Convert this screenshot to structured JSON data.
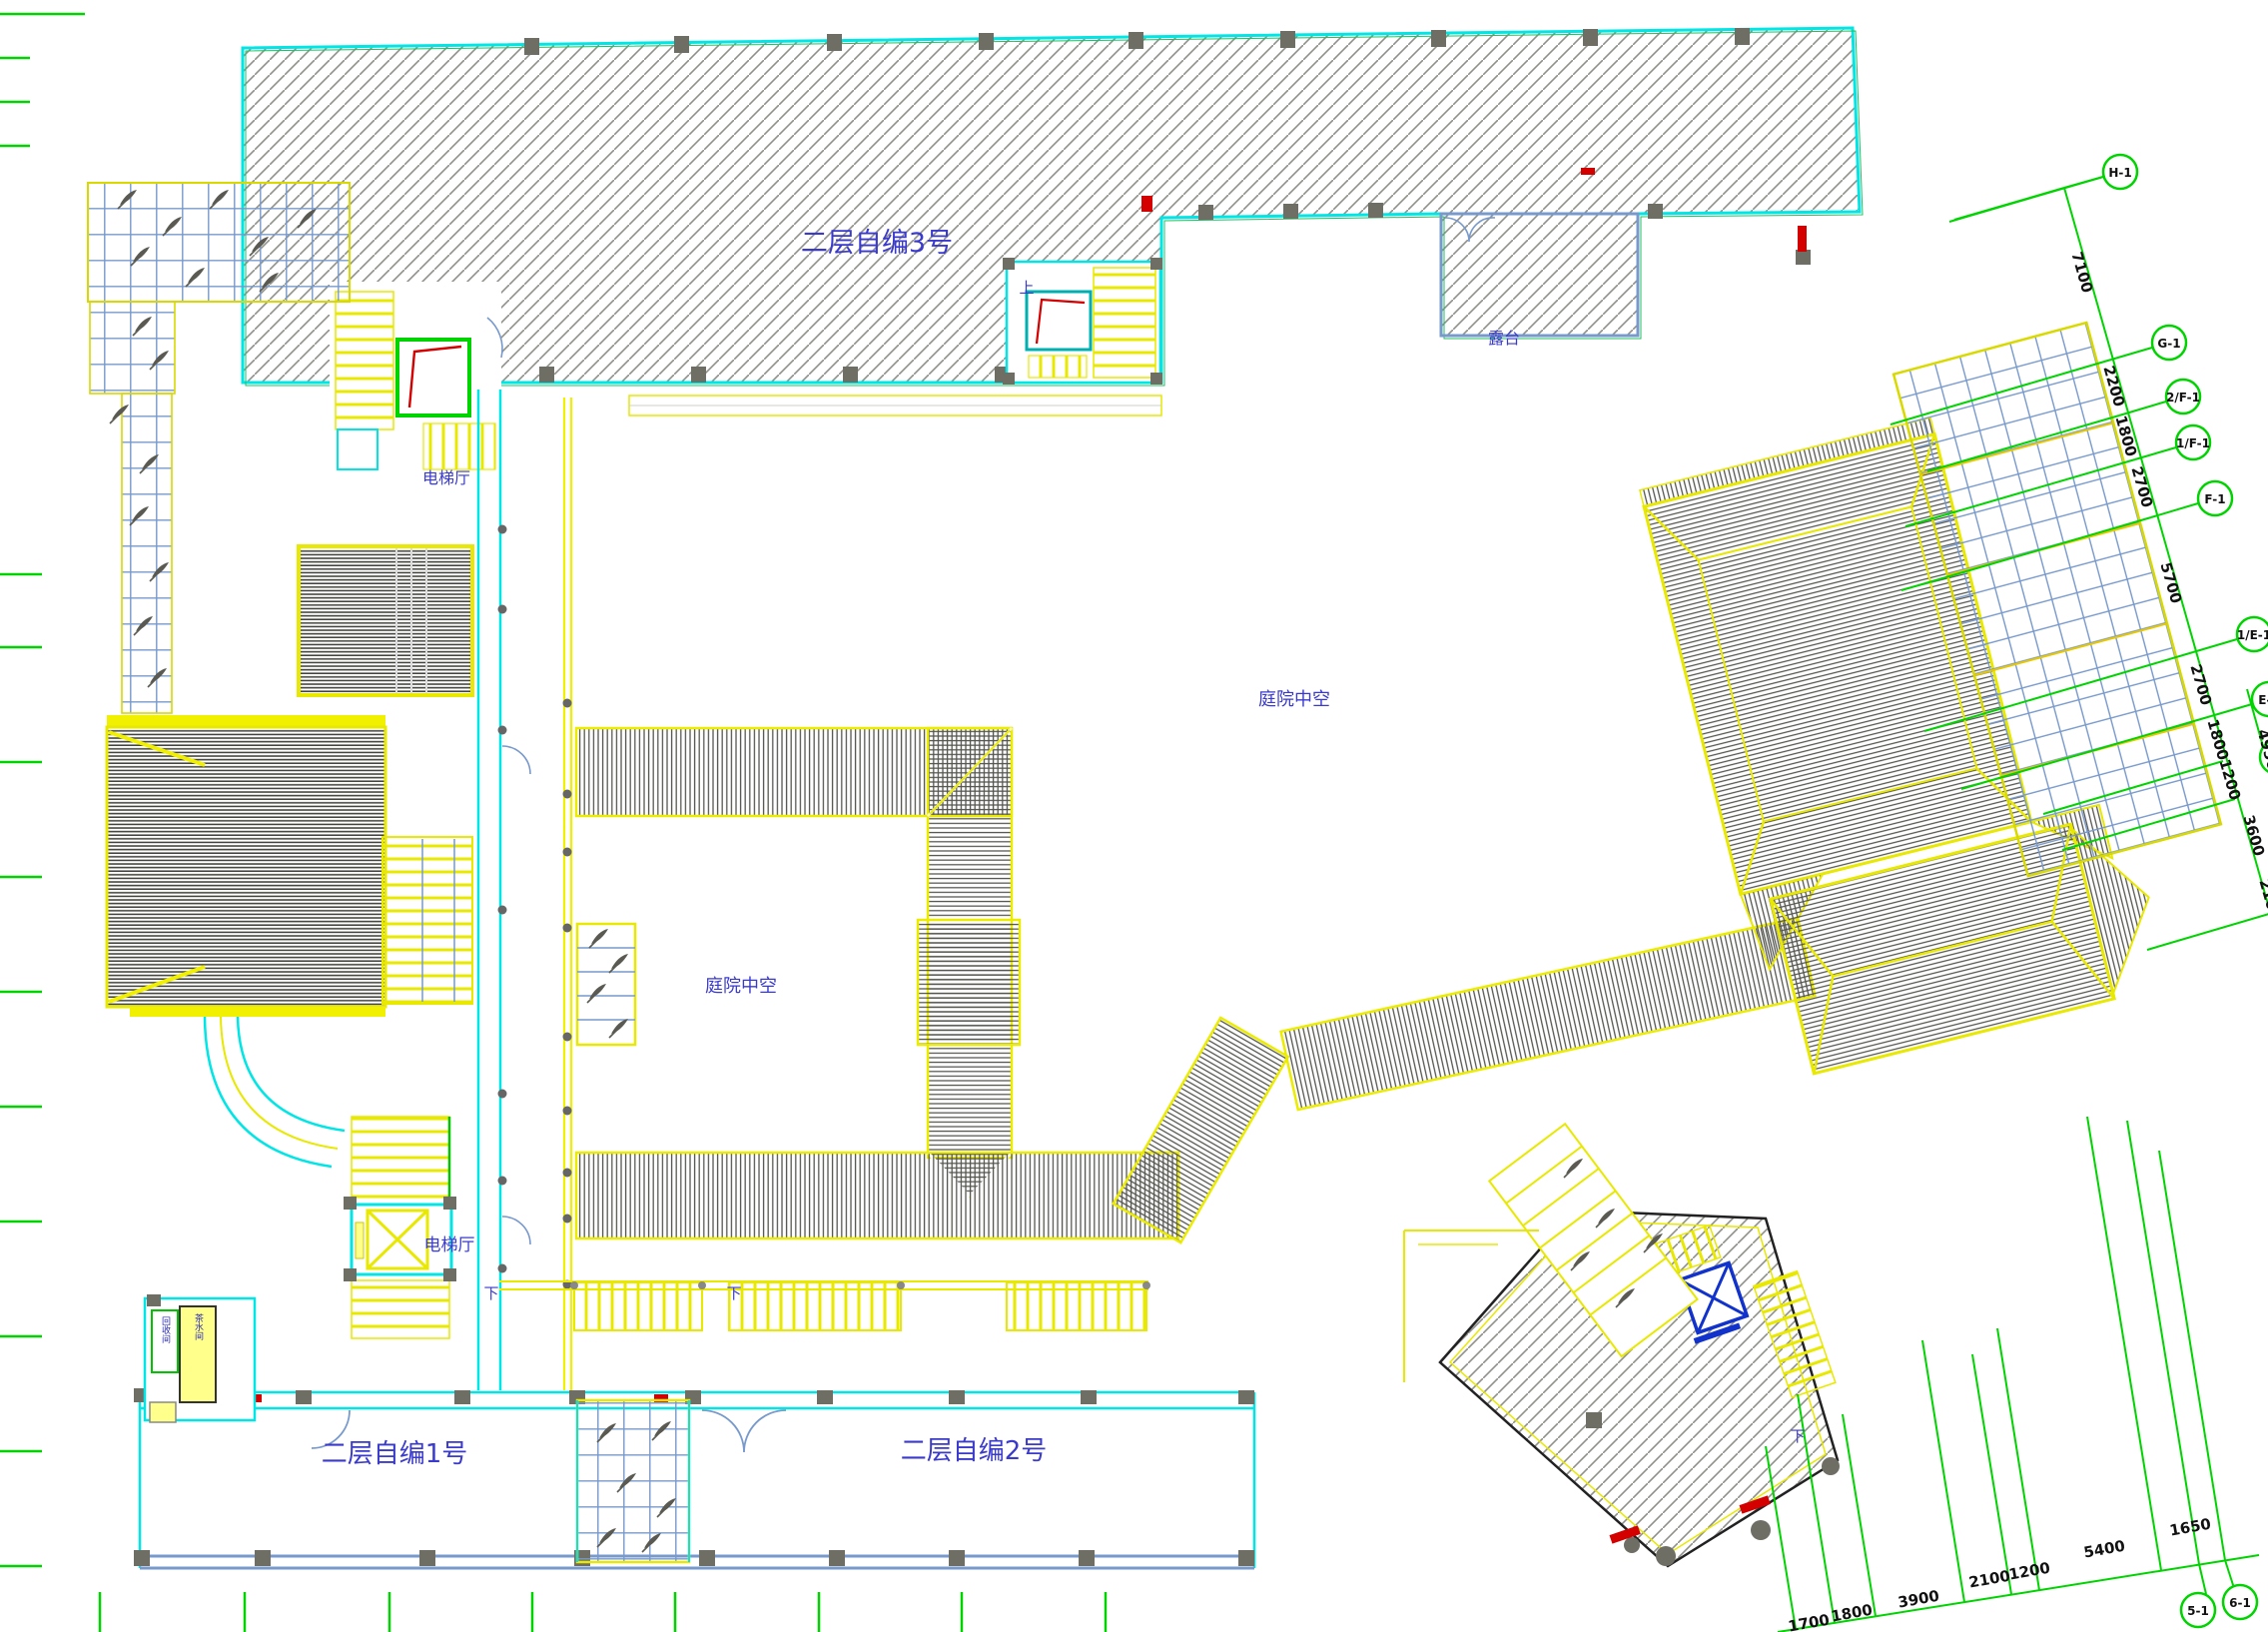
{
  "labels": {
    "building3": "二层自编3号",
    "building1": "二层自编1号",
    "building2": "二层自编2号",
    "terrace": "露台",
    "courtyard": "庭院中空",
    "elevator_hall": "电梯厅",
    "up": "上",
    "down": "下",
    "tea_room": "茶水间",
    "recycle_room": "回收间"
  },
  "axis_right": {
    "circles": [
      "H-1",
      "G-1",
      "2/F-1",
      "1/F-1",
      "F-1",
      "1/E-1",
      "E-1"
    ],
    "dims": [
      "7100",
      "2200",
      "1800",
      "2700",
      "5700",
      "2700",
      "1800",
      "1200",
      "4950",
      "3600",
      "2100"
    ]
  },
  "axis_bottom": {
    "circles": [
      "5-1",
      "6-1"
    ],
    "dims": [
      "1700",
      "1800",
      "3900",
      "2100",
      "1200",
      "5400",
      "1650"
    ]
  },
  "colors": {
    "wall_cyan": "#00e5e5",
    "line_yellow": "#f0f000",
    "axis_green": "#00d400",
    "hatch_gray": "#8c8c86",
    "label_blue": "#3a3acc",
    "grid_blue": "#7799cc",
    "accent_red": "#e00000",
    "outline_dark": "#222222"
  }
}
